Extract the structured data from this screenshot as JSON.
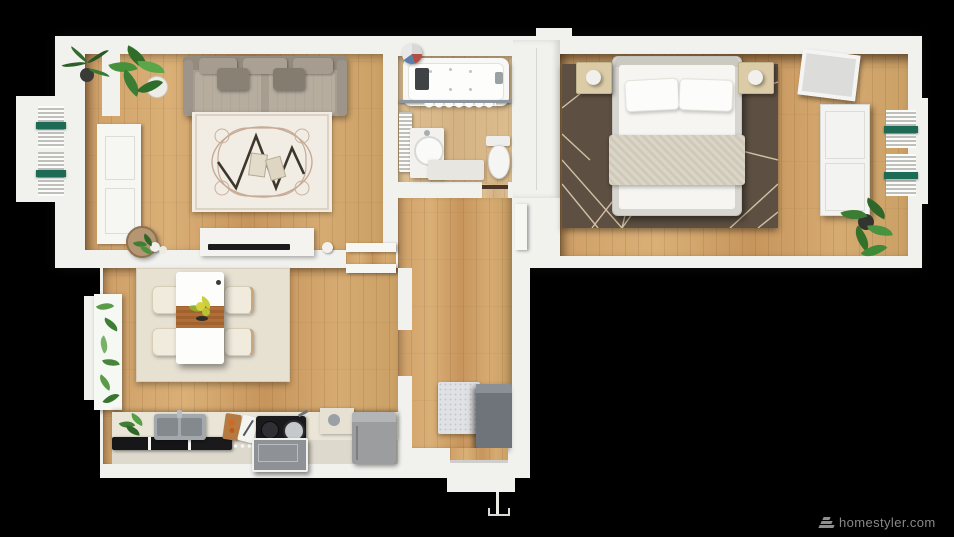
{
  "watermark": {
    "text": "homestyler.com",
    "icon": "homestyler-layers-icon",
    "color": "#979797"
  },
  "scene": {
    "type": "3d-rendered-floor-plan-top-view",
    "background_color": "#000000",
    "palette": {
      "walls": "#f1f1ee",
      "wood_floor": "#d1a46c",
      "wood_floor_light": "#dcbd8f",
      "living_rug": "#f2ede4",
      "bedroom_rug": "#5d5042",
      "dining_rug": "#e7e1d2",
      "sofa": "#a79e92",
      "bedding": "#f6f5f1",
      "radiator_accent_green": "#1d6b55",
      "plant_green": "#47913a",
      "kitchen_counter": "#eae5d7",
      "cooktop_black": "#1a1a1d",
      "cabinet_gray": "#9c9d9f",
      "shoe_cabinet_gray": "#6e747a"
    },
    "rooms": [
      {
        "name": "living-room",
        "furniture": [
          "sofa-with-pillows",
          "ornate-area-rug",
          "zigzag-rug-motif",
          "coffee-table-books",
          "tv-console",
          "tv-panel",
          "round-side-table",
          "decor-spheres",
          "potted-plant-spiky",
          "potted-plant-broadleaf",
          "small-plant",
          "balcony-door-leaf",
          "window-radiator-green-accents",
          "wall-pier"
        ]
      },
      {
        "name": "bathroom",
        "furniture": [
          "jacuzzi-bathtub",
          "tub-jets",
          "shower-rod",
          "shower-curtain",
          "vanity-with-round-basin",
          "wall-radiator",
          "toilet",
          "bath-mat",
          "towel-basket",
          "dark-caddy",
          "door-threshold"
        ]
      },
      {
        "name": "bedroom",
        "furniture": [
          "double-bed",
          "pillows",
          "textured-blanket",
          "geometric-dark-rug",
          "nightstand-left-with-lamp",
          "nightstand-right-with-lamp",
          "leaning-mirror",
          "wardrobe-two-doors",
          "window-radiator-green-accents",
          "potted-plant",
          "open-door-leaf"
        ]
      },
      {
        "name": "kitchen-dining",
        "furniture": [
          "dining-table",
          "wood-table-runner",
          "flower-centerpiece",
          "dining-chairs-x4",
          "beige-area-rug",
          "leaf-print-curtain",
          "window-frame",
          "kitchen-counter-run",
          "double-basin-sink",
          "black-glass-cabinet-fronts",
          "wood-cutting-board",
          "white-cutting-board",
          "black-cooktop-with-pans",
          "control-knobs",
          "kitchen-cart",
          "cream-cabinet-with-pot",
          "gray-tall-cabinet",
          "counter-plant"
        ]
      },
      {
        "name": "hallway-entry",
        "furniture": [
          "tall-closet-column",
          "speckled-doormat",
          "shoe-cabinet",
          "entry-threshold",
          "entry-step",
          "open-entry-door-line"
        ]
      }
    ]
  }
}
